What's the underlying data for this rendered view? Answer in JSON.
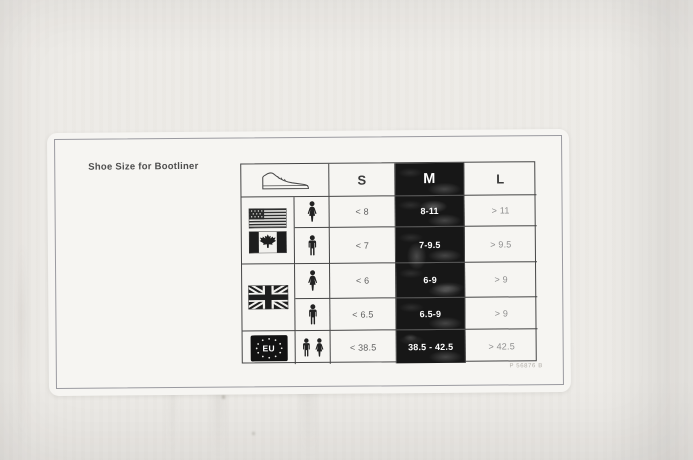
{
  "photo": {
    "background_color": "#edebe7",
    "label_background": "#f6f5f2"
  },
  "label": {
    "title": "Shoe Size for Bootliner",
    "footer_code": "P 56876 B"
  },
  "size_chart": {
    "type": "table",
    "header": {
      "icon": "sneaker-icon",
      "columns": [
        "S",
        "M",
        "L"
      ]
    },
    "highlight_column": "M",
    "groups": [
      {
        "flags": [
          "usa-flag",
          "canada-flag"
        ],
        "rows": [
          {
            "gender": "women",
            "s": "< 8",
            "m": "8-11",
            "l": "> 11"
          },
          {
            "gender": "men",
            "s": "< 7",
            "m": "7-9.5",
            "l": "> 9.5"
          }
        ]
      },
      {
        "flags": [
          "uk-flag"
        ],
        "rows": [
          {
            "gender": "women",
            "s": "< 6",
            "m": "6-9",
            "l": "> 9"
          },
          {
            "gender": "men",
            "s": "< 6.5",
            "m": "6.5-9",
            "l": "> 9"
          }
        ]
      },
      {
        "flags": [
          "eu-badge"
        ],
        "badge_label": "EU",
        "rows": [
          {
            "gender": "unisex",
            "s": "< 38.5",
            "m": "38.5 - 42.5",
            "l": "> 42.5"
          }
        ]
      }
    ],
    "colors": {
      "highlight_bg": "#171717",
      "highlight_text": "#ffffff",
      "table_border": "#454545",
      "value_text": "#5f5f5f",
      "faded_value_text": "#8f8f8f"
    }
  }
}
